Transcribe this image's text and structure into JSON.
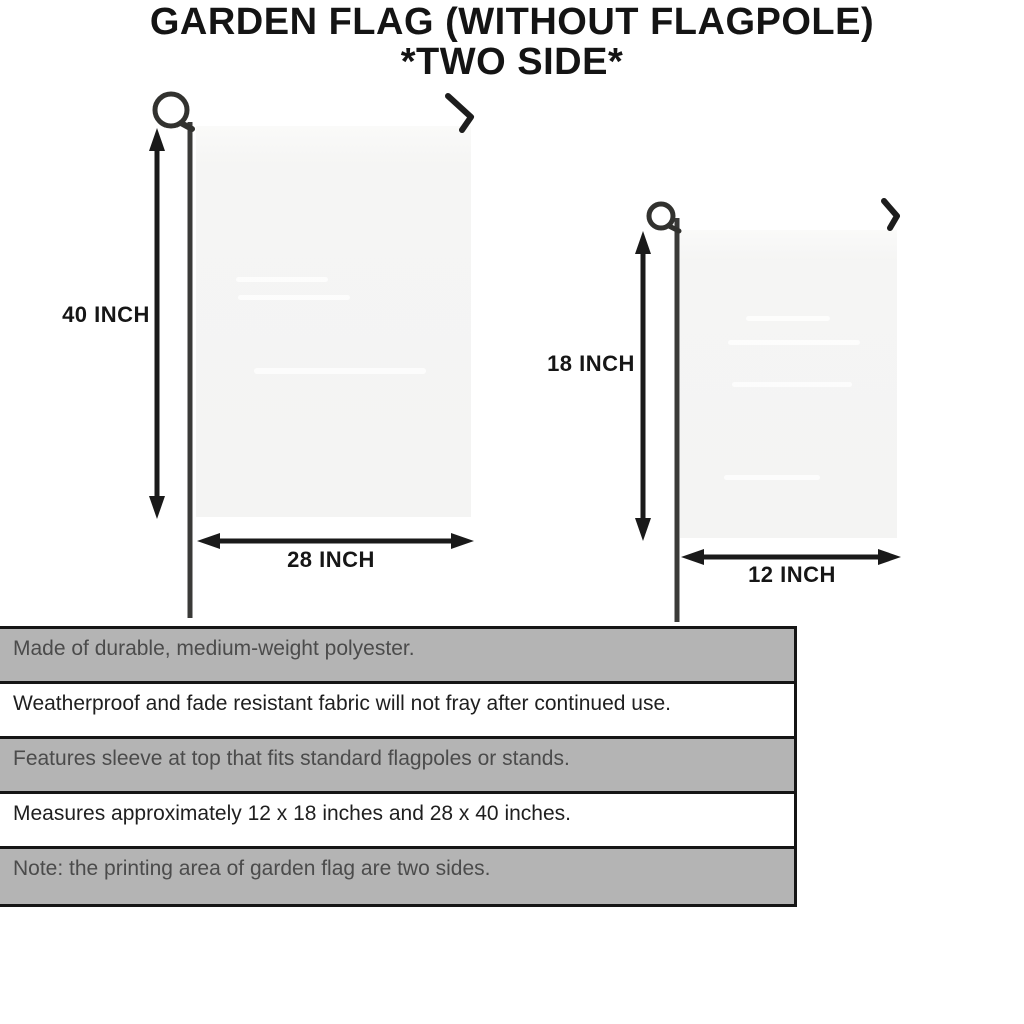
{
  "title": {
    "line1": "GARDEN FLAG (WITHOUT FLAGPOLE)",
    "line2": "*TWO SIDE*"
  },
  "diagrams": {
    "large_flag": {
      "height_label": "40 INCH",
      "width_label": "28 INCH"
    },
    "small_flag": {
      "height_label": "18 INCH",
      "width_label": "12 INCH"
    }
  },
  "spec_table": {
    "rows": [
      {
        "text": "Made of durable, medium-weight polyester.",
        "shade": "gray"
      },
      {
        "text": "Weatherproof and fade resistant fabric will not fray after continued use.",
        "shade": "white"
      },
      {
        "text": "Features sleeve at top that fits standard flagpoles or stands.",
        "shade": "gray"
      },
      {
        "text": "Measures approximately 12 x 18 inches and 28 x 40 inches.",
        "shade": "white"
      },
      {
        "text": "Note: the printing area of garden flag are two sides.",
        "shade": "gray"
      }
    ]
  },
  "colors": {
    "line_art": "#1d1d1d",
    "pole": "#3a3a38",
    "flag_fill": "#f5f5f4",
    "table_row_gray": "#b4b4b4",
    "table_border": "#161616"
  }
}
